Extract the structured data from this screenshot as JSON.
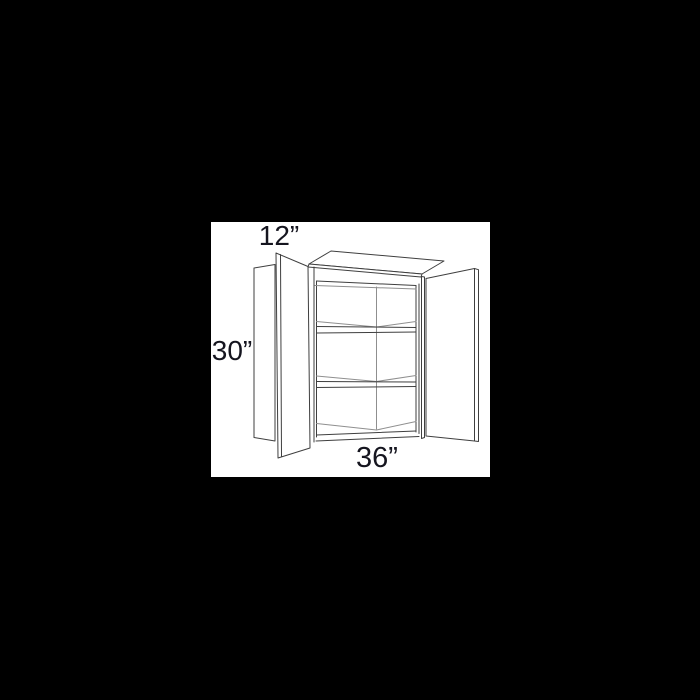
{
  "scene": {
    "background_color": "#000000",
    "panel_color": "#ffffff"
  },
  "diagram": {
    "type": "cabinet-line-drawing",
    "labels": {
      "depth": "12”",
      "height": "30”",
      "width": "36”"
    },
    "colors": {
      "line_primary": "#3f3f3f",
      "line_secondary": "#8f8f8f",
      "label_text": "#15151f"
    }
  }
}
